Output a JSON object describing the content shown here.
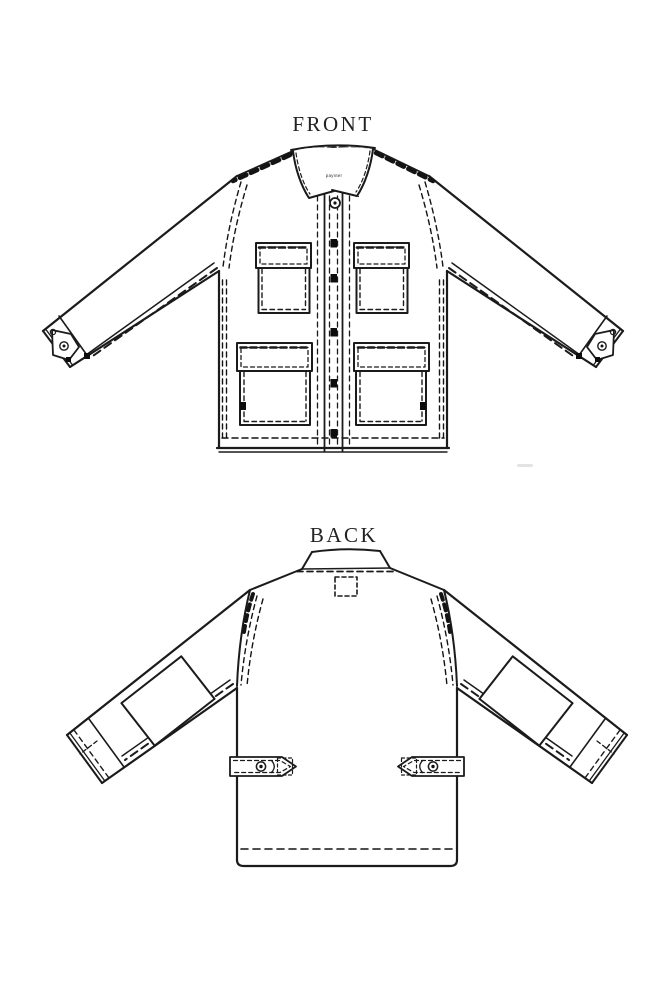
{
  "labels": {
    "front": "FRONT",
    "back": "BACK",
    "brand": "paynter"
  },
  "style": {
    "line_color": "#1b1b1b",
    "heavy_line_color": "#0f0f0f",
    "background": "#ffffff"
  },
  "diagram": {
    "type": "garment-technical-flat-sketch",
    "garment": "chore-jacket",
    "views": [
      {
        "name": "front",
        "label": "FRONT",
        "visible_features": [
          "collar",
          "brand-neck-label",
          "button-placket",
          "top-button",
          "5-placket-buttons",
          "2-chest-flap-pockets",
          "2-lower-flap-pockets",
          "cuff-tab-buttons",
          "dashed-topstitching"
        ]
      },
      {
        "name": "back",
        "label": "BACK",
        "visible_features": [
          "back-collar",
          "dashed-label-stitch-box",
          "2-elbow-patches",
          "2-waist-adjuster-tabs-with-buttons",
          "hem-topstitching"
        ]
      }
    ]
  }
}
